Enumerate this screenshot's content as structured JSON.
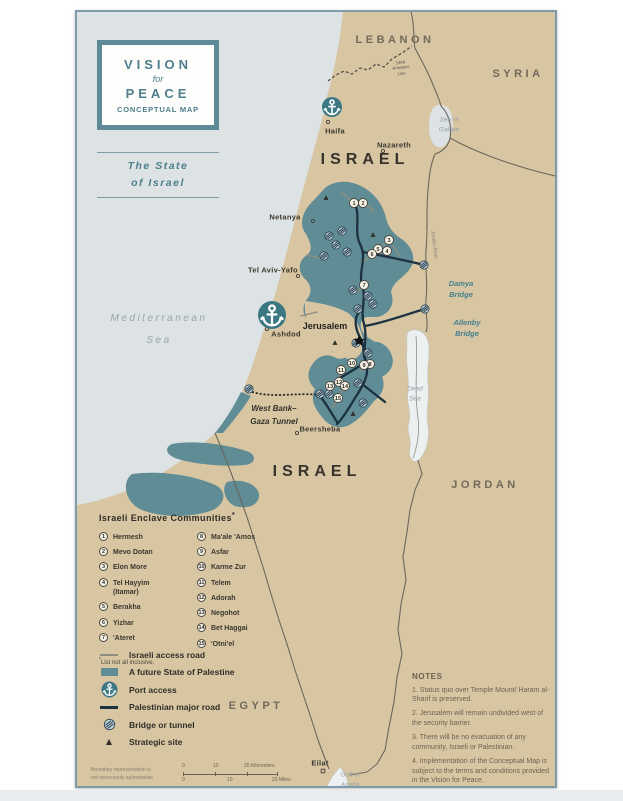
{
  "colors": {
    "land": "#d8c5a2",
    "sea": "#dde2e4",
    "palestine": "#5f8c95",
    "frame": "#7e9da8",
    "teal": "#4e7f8c",
    "road_dark": "#1d3240",
    "road_gray": "#8f8d80",
    "border": "#6b685c",
    "dead_sea": "#edf0f0",
    "bridge_fill": "#c3d8dd",
    "bridge_stroke": "#23384a",
    "text_dark": "#35332c",
    "text_country": "#716a5a",
    "text_sea": "#9aa5a8",
    "notes_text": "#6e6353",
    "marker_fill": "#f7f3e8"
  },
  "title_box": {
    "line1": "VISION",
    "line2": "for",
    "line3": "PEACE",
    "line4": "CONCEPTUAL MAP"
  },
  "subtitle": {
    "line1": "The State",
    "line2": "of Israel"
  },
  "map": {
    "labels": [
      {
        "name": "label-lebanon",
        "text": "LEBANON",
        "x": 318,
        "y": 28,
        "cls": "country"
      },
      {
        "name": "label-syria",
        "text": "SYRIA",
        "x": 441,
        "y": 62,
        "cls": "country"
      },
      {
        "name": "label-israel-north",
        "text": "ISRAEL",
        "x": 288,
        "y": 148,
        "cls": "country-big"
      },
      {
        "name": "label-israel-south",
        "text": "ISRAEL",
        "x": 240,
        "y": 460,
        "cls": "country-big"
      },
      {
        "name": "label-jordan",
        "text": "JORDAN",
        "x": 408,
        "y": 473,
        "cls": "country"
      },
      {
        "name": "label-egypt",
        "text": "EGYPT",
        "x": 179,
        "y": 694,
        "cls": "country"
      },
      {
        "name": "label-mediterranean-sea",
        "text": "Mediterranean\nSea",
        "x": 82,
        "y": 318,
        "cls": "sea-big"
      },
      {
        "name": "label-sea-of-galilee",
        "text": "Sea of\nGalilee",
        "x": 372,
        "y": 113,
        "cls": "sea-small"
      },
      {
        "name": "label-dead-sea",
        "text": "Dead\nSea",
        "x": 338,
        "y": 382,
        "cls": "sea-small"
      },
      {
        "name": "label-gulf-of-aqaba",
        "text": "Gulf of\nAqaba",
        "x": 273,
        "y": 768,
        "cls": "sea-small"
      },
      {
        "name": "label-haifa",
        "text": "Haifa",
        "x": 258,
        "y": 119,
        "cls": "city"
      },
      {
        "name": "label-nazareth",
        "text": "Nazareth",
        "x": 317,
        "y": 133,
        "cls": "city"
      },
      {
        "name": "label-netanya",
        "text": "Netanya",
        "x": 208,
        "y": 205,
        "cls": "city"
      },
      {
        "name": "label-tel-aviv-yafo",
        "text": "Tel Aviv-Yafo",
        "x": 196,
        "y": 258,
        "cls": "city"
      },
      {
        "name": "label-ashdod",
        "text": "Ashdod",
        "x": 209,
        "y": 322,
        "cls": "city"
      },
      {
        "name": "label-jerusalem",
        "text": "Jerusalem",
        "x": 248,
        "y": 314,
        "cls": "city-bold"
      },
      {
        "name": "label-beersheba",
        "text": "Beersheba",
        "x": 243,
        "y": 417,
        "cls": "city"
      },
      {
        "name": "label-eilat",
        "text": "Eilat",
        "x": 243,
        "y": 751,
        "cls": "city"
      },
      {
        "name": "label-damya-bridge",
        "text": "Damya\nBridge",
        "x": 384,
        "y": 277,
        "cls": "bridge"
      },
      {
        "name": "label-allenby-bridge",
        "text": "Allenby\nBridge",
        "x": 390,
        "y": 316,
        "cls": "bridge"
      },
      {
        "name": "label-west-bank-gaza-tunnel",
        "text": "West Bank–\nGaza Tunnel",
        "x": 197,
        "y": 404,
        "cls": "tunnel-label"
      },
      {
        "name": "label-1949-armistice-line",
        "text": "1949\nArmistice\nLine",
        "x": 324,
        "y": 56,
        "cls": "micro",
        "rot": -6
      },
      {
        "name": "label-jordan-river",
        "text": "Jordan River",
        "x": 357,
        "y": 233,
        "cls": "micro-river",
        "rot": 83
      }
    ],
    "city_dots": [
      {
        "city": "Haifa",
        "x": 251,
        "y": 110
      },
      {
        "city": "Nazareth",
        "x": 306,
        "y": 139
      },
      {
        "city": "Netanya",
        "x": 236,
        "y": 209
      },
      {
        "city": "Tel Aviv-Yafo",
        "x": 221,
        "y": 264
      },
      {
        "city": "Ashdod",
        "x": 190,
        "y": 317
      },
      {
        "city": "Beersheba",
        "x": 220,
        "y": 421
      },
      {
        "city": "Eilat",
        "x": 246,
        "y": 759,
        "shape": "square"
      }
    ],
    "ports": [
      {
        "city": "Haifa",
        "x": 255,
        "y": 95,
        "r": 10
      },
      {
        "city": "Ashdod",
        "x": 195,
        "y": 303,
        "r": 14
      }
    ],
    "bridge_icons": [
      {
        "x": 252,
        "y": 224
      },
      {
        "x": 265,
        "y": 219
      },
      {
        "x": 259,
        "y": 233
      },
      {
        "x": 247,
        "y": 244
      },
      {
        "x": 270,
        "y": 240
      },
      {
        "x": 276,
        "y": 278
      },
      {
        "x": 291,
        "y": 284
      },
      {
        "x": 281,
        "y": 297
      },
      {
        "x": 296,
        "y": 292
      },
      {
        "x": 279,
        "y": 331
      },
      {
        "x": 291,
        "y": 341
      },
      {
        "x": 347,
        "y": 253
      },
      {
        "x": 348,
        "y": 297
      },
      {
        "x": 252,
        "y": 382
      },
      {
        "x": 281,
        "y": 371
      },
      {
        "x": 286,
        "y": 391
      },
      {
        "x": 243,
        "y": 382
      },
      {
        "x": 172,
        "y": 377
      }
    ],
    "strategic_sites": [
      {
        "x": 249,
        "y": 186
      },
      {
        "x": 296,
        "y": 223
      },
      {
        "x": 258,
        "y": 331
      },
      {
        "x": 276,
        "y": 402
      }
    ],
    "jerusalem_star": {
      "x": 282,
      "y": 329
    },
    "enclave_markers": [
      {
        "n": 1,
        "x": 277,
        "y": 191
      },
      {
        "n": 2,
        "x": 286,
        "y": 191
      },
      {
        "n": 3,
        "x": 312,
        "y": 228
      },
      {
        "n": 4,
        "x": 310,
        "y": 239
      },
      {
        "n": 5,
        "x": 301,
        "y": 237
      },
      {
        "n": 6,
        "x": 295,
        "y": 242
      },
      {
        "n": 7,
        "x": 287,
        "y": 273
      },
      {
        "n": 8,
        "x": 293,
        "y": 352
      },
      {
        "n": 9,
        "x": 287,
        "y": 353
      },
      {
        "n": 10,
        "x": 275,
        "y": 351
      },
      {
        "n": 11,
        "x": 264,
        "y": 358
      },
      {
        "n": 12,
        "x": 262,
        "y": 370
      },
      {
        "n": 13,
        "x": 253,
        "y": 374
      },
      {
        "n": 14,
        "x": 268,
        "y": 374
      },
      {
        "n": 15,
        "x": 261,
        "y": 386
      }
    ]
  },
  "enclaves": {
    "title": "Israeli Enclave Communities",
    "footnote_mark": "*",
    "footnote": "List not all inclusive.",
    "items": [
      {
        "n": 1,
        "name": "Hermesh"
      },
      {
        "n": 2,
        "name": "Mevo Dotan"
      },
      {
        "n": 3,
        "name": "Elon More"
      },
      {
        "n": 4,
        "name": "Tel Hayyim\n(Itamar)"
      },
      {
        "n": 5,
        "name": "Berakha"
      },
      {
        "n": 6,
        "name": "Yizhar"
      },
      {
        "n": 7,
        "name": "'Ateret"
      },
      {
        "n": 8,
        "name": "Ma'ale 'Amos"
      },
      {
        "n": 9,
        "name": "Asfar"
      },
      {
        "n": 10,
        "name": "Karme Zur"
      },
      {
        "n": 11,
        "name": "Telem"
      },
      {
        "n": 12,
        "name": "Adorah"
      },
      {
        "n": 13,
        "name": "Negohot"
      },
      {
        "n": 14,
        "name": "Bet Haggai"
      },
      {
        "n": 15,
        "name": "'Otni'el"
      }
    ]
  },
  "legend": {
    "items": [
      {
        "icon": "road-gray",
        "label": "Israeli access road"
      },
      {
        "icon": "swatch",
        "label": "A future State of Palestine"
      },
      {
        "icon": "port",
        "label": "Port access"
      },
      {
        "icon": "road-dark",
        "label": "Palestinian major road"
      },
      {
        "icon": "bridge",
        "label": "Bridge or tunnel"
      },
      {
        "icon": "strategic",
        "label": "Strategic site"
      }
    ]
  },
  "notes": {
    "title": "NOTES",
    "items": [
      "1. Status quo over Temple Mount/ Haram al-Sharif is preserved.",
      "2. Jerusalem will remain undivided west of the security barrier.",
      "3. There will be no evacuation of any community, Israeli or Palestinian.",
      "4. Implementation of the Conceptual Map is subject to the terms and conditions provided in the Vision for Peace."
    ]
  },
  "scale": {
    "km": [
      "0",
      "10",
      "20 Kilometers"
    ],
    "mi": [
      "0",
      "10",
      "20 Miles"
    ],
    "disclaimer": "Boundary representation is\nnot necessarily authoritative."
  }
}
